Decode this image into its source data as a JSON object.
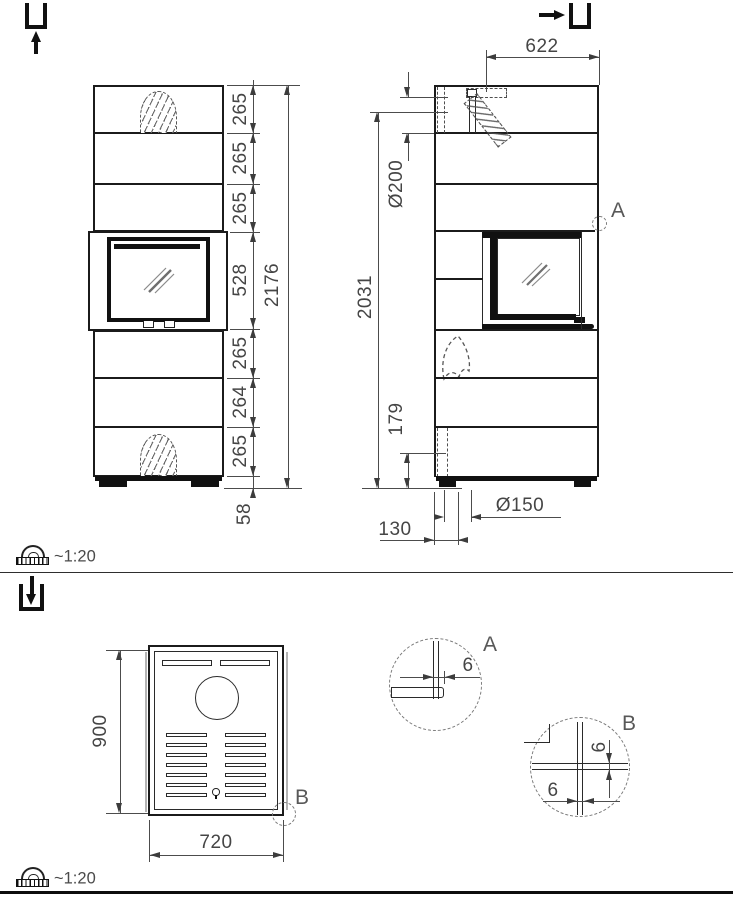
{
  "scale": {
    "top": "~1:20",
    "bottom": "~1:20"
  },
  "front": {
    "chain": [
      "265",
      "265",
      "265",
      "528",
      "265",
      "264",
      "265"
    ],
    "total": "2176",
    "plinth": "58"
  },
  "side": {
    "top_width": "622",
    "flue_diameter": "Ø200",
    "height": "2031",
    "outlet_height": "179",
    "outlet_offset": "130",
    "outlet_diameter": "Ø150",
    "detail_ref": "A"
  },
  "top": {
    "depth": "900",
    "width": "720",
    "detail_ref": "B"
  },
  "detail_a": {
    "label": "A",
    "gap": "6"
  },
  "detail_b": {
    "label": "B",
    "gap_vertical": "6",
    "gap_horizontal": "6"
  },
  "colors": {
    "line": "#1b1b1b",
    "dim": "#4c4c4c"
  }
}
